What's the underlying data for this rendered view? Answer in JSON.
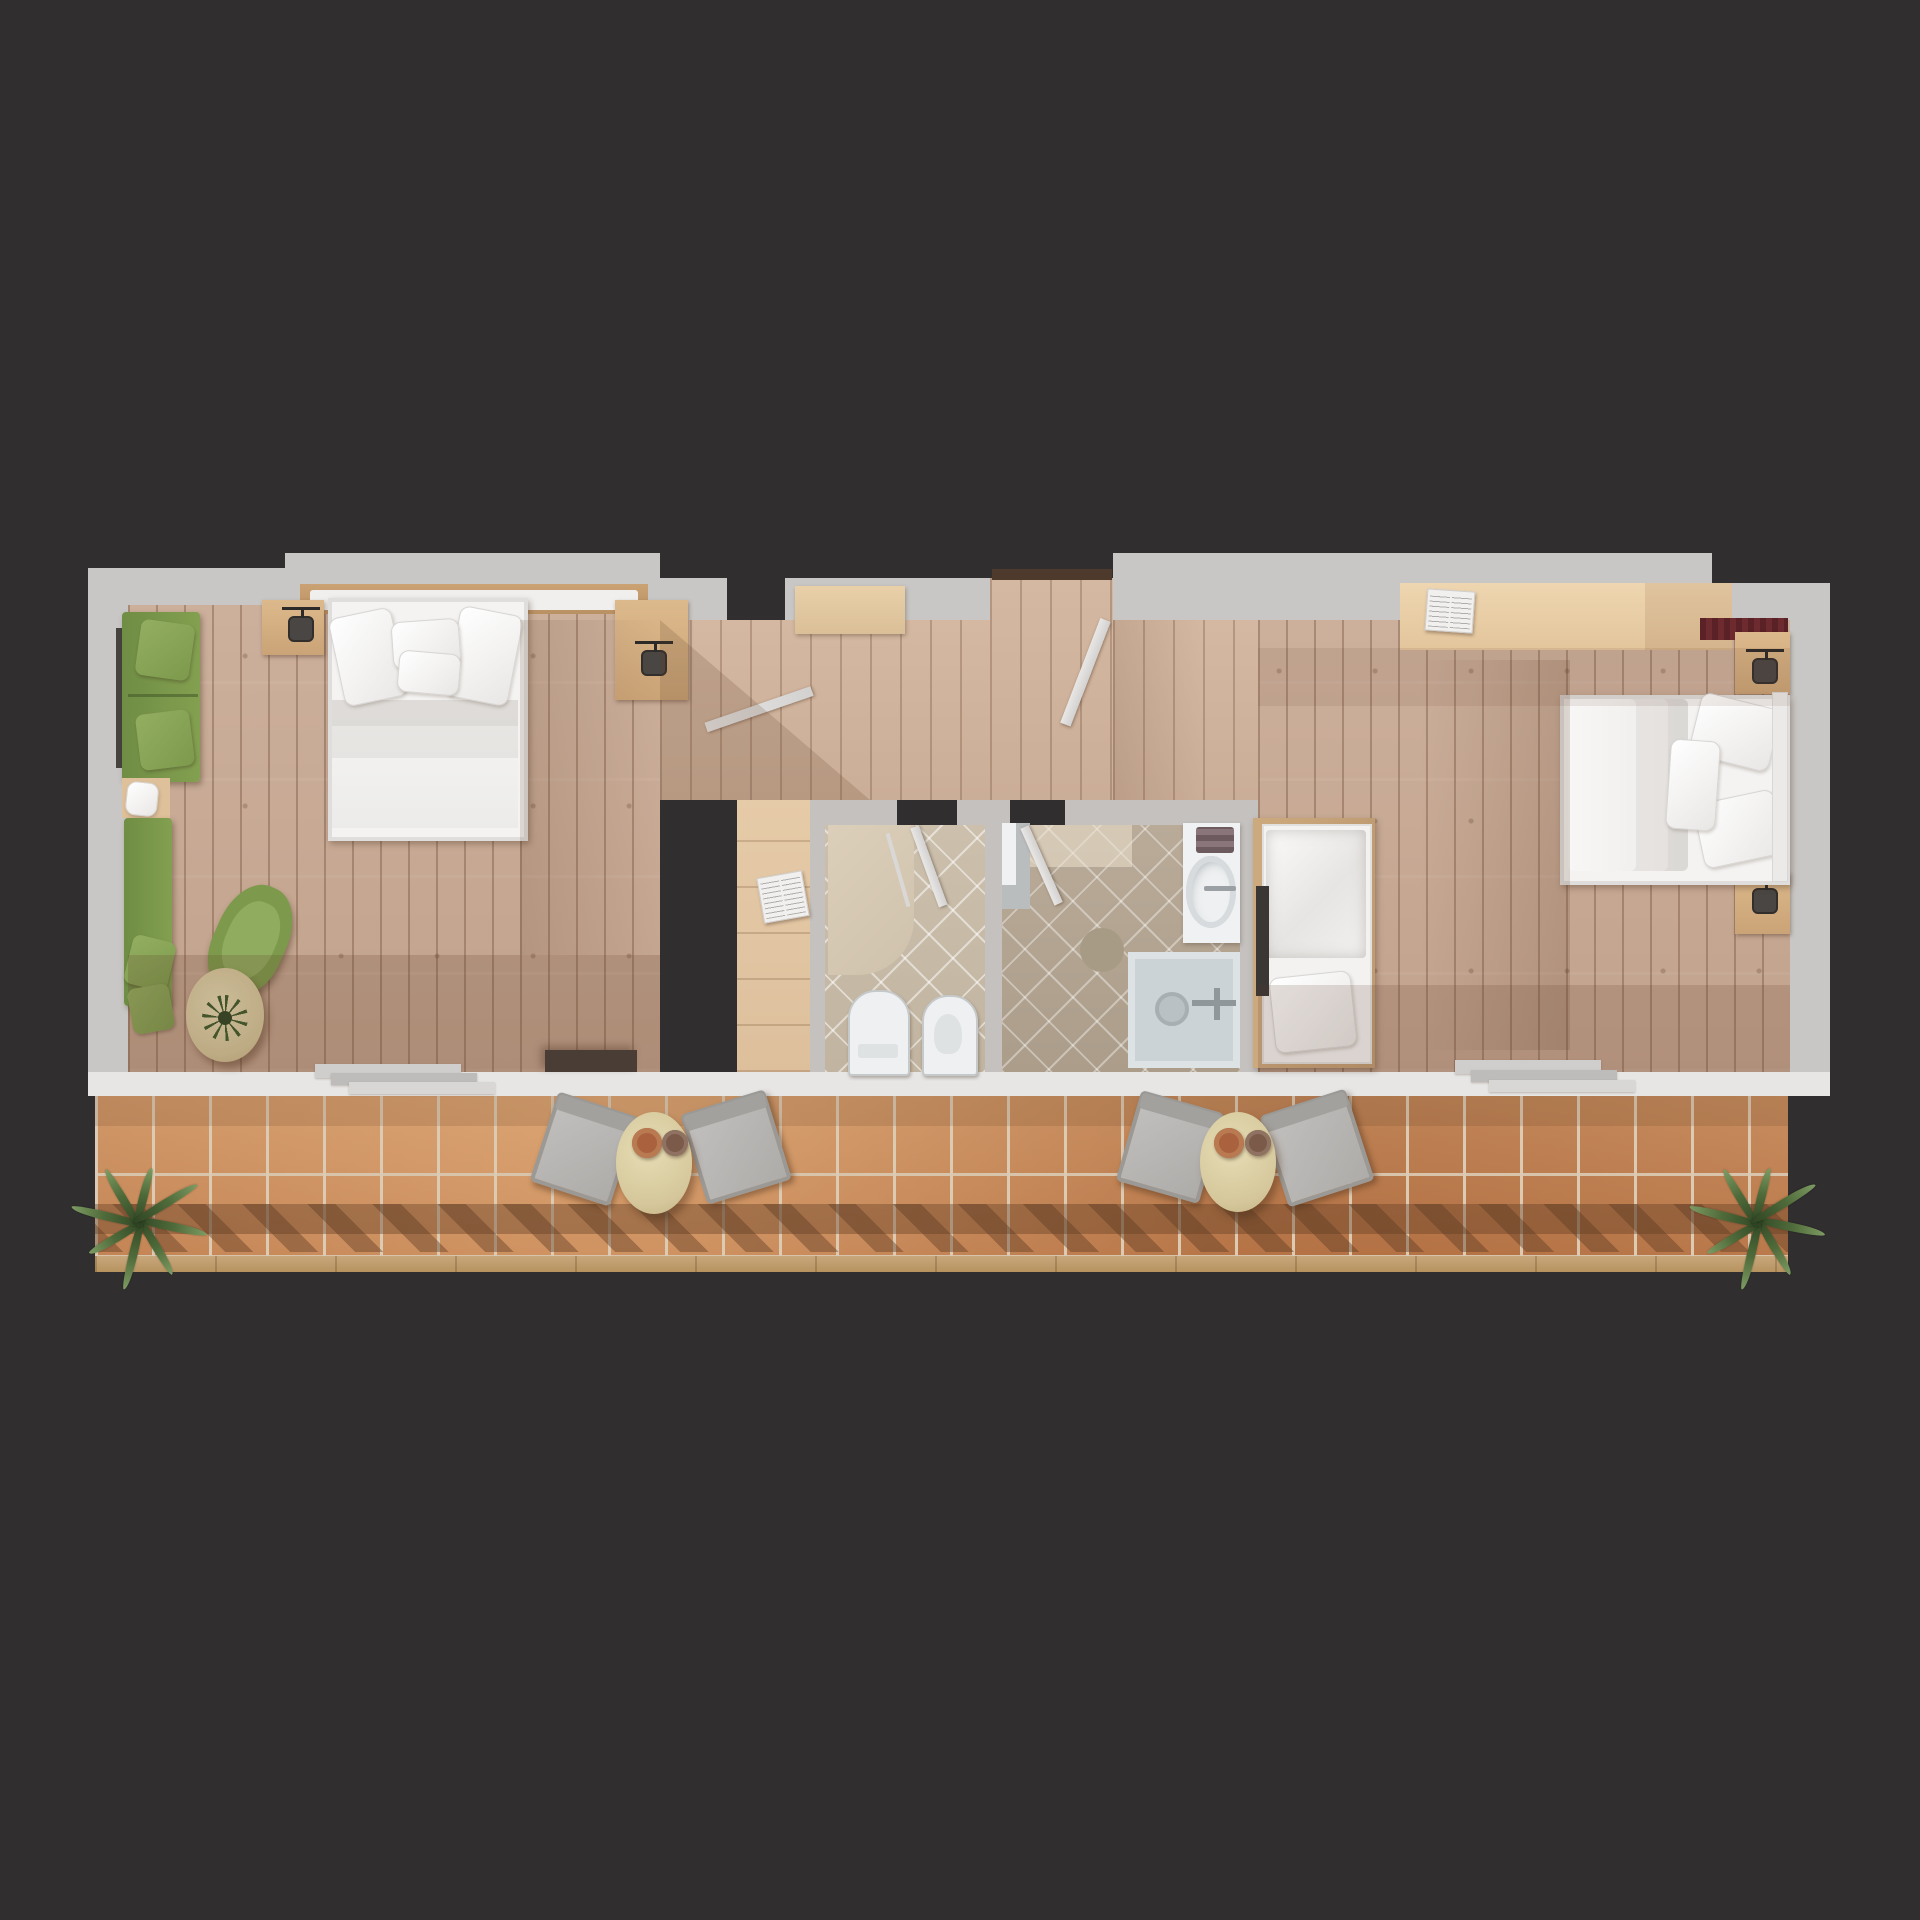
{
  "scene": {
    "title": "Two-bedroom apartment with two bathrooms and long terrace — rendered floor plan, top view",
    "render_style": "3D architectural top-down render",
    "background_color": "#302e2e"
  },
  "palette": {
    "wall_gray": "#c9c7c5",
    "wall_white": "#e7e6e5",
    "wood_floor": "#c8ab97",
    "wood_light_nook": "#e2c7a5",
    "bath_tile_light": "#ccc0ad",
    "bath_tile_dark": "#b3a592",
    "terracotta_tile": "#c98f60",
    "bed_linen_white": "#f3f2f1",
    "sofa_green": "#82a04f",
    "table_cream": "#d8cb9f",
    "chair_gray": "#b5b3b1",
    "plant_green": "#4f6b3a",
    "rug_maroon": "#5a2126",
    "shadow_brown": "rgba(94,62,40,0.2)"
  },
  "rooms": {
    "bedroom_left": {
      "label": "Bedroom 1 (left) — double bed, green sofa and lounge corner"
    },
    "hallway": {
      "label": "Entry hall with open door"
    },
    "nook": {
      "label": "Dressing nook with book"
    },
    "bathroom_left": {
      "label": "Bathroom 1 — shower, WC and bidet"
    },
    "bathroom_right": {
      "label": "Bathroom 2 — washbasin and shower tray"
    },
    "bedroom_right": {
      "label": "Bedroom 2 (right) — double bed and single bed"
    },
    "terrace": {
      "label": "Terrace with terracotta tiles, loungers and palms"
    }
  },
  "furniture": {
    "double_bed": {
      "label": "Double bed with white duvet and pillows"
    },
    "single_bed": {
      "label": "Single bed with blanket and pillow"
    },
    "headboard": {
      "label": "Headboard shelf"
    },
    "nightstand": {
      "label": "Nightstand"
    },
    "wall_lamp": {
      "label": "Wall lamp"
    },
    "sofa": {
      "label": "Green sofa"
    },
    "bench": {
      "label": "Green daybed bench"
    },
    "side_table": {
      "label": "Wood side table with cushion"
    },
    "armchair": {
      "label": "Green tub armchair"
    },
    "coffee_table": {
      "label": "Round coffee table"
    },
    "plant": {
      "label": "Table plant"
    },
    "console": {
      "label": "Dark media console"
    },
    "desk": {
      "label": "Desk / wardrobe top"
    },
    "entry_bench": {
      "label": "Entry bench"
    },
    "book": {
      "label": "Open book"
    },
    "rug": {
      "label": "Maroon runner rug"
    },
    "tv_panel": {
      "label": "TV panel"
    },
    "door": {
      "label": "Open door leaf"
    },
    "threshold": {
      "label": "Entrance threshold"
    },
    "terrace_steps": {
      "label": "Terrace door steps"
    },
    "wc": {
      "label": "Toilet"
    },
    "bidet": {
      "label": "Bidet"
    },
    "shower_zone": {
      "label": "Walk-in shower"
    },
    "shower_glass": {
      "label": "Shower glass panel"
    },
    "vanity": {
      "label": "Vanity with washbasin"
    },
    "sink": {
      "label": "Oval washbasin"
    },
    "towels": {
      "label": "Folded towels"
    },
    "bath_mat": {
      "label": "Round bath mat"
    },
    "shower_tray": {
      "label": "Shower tray with drain"
    },
    "terrace_chair": {
      "label": "Folding terrace chair"
    },
    "terrace_table": {
      "label": "Round terrace side table"
    },
    "cup": {
      "label": "Cup"
    },
    "palm": {
      "label": "Palm plant"
    },
    "railing_shadow": {
      "label": "Railing shadow"
    }
  }
}
